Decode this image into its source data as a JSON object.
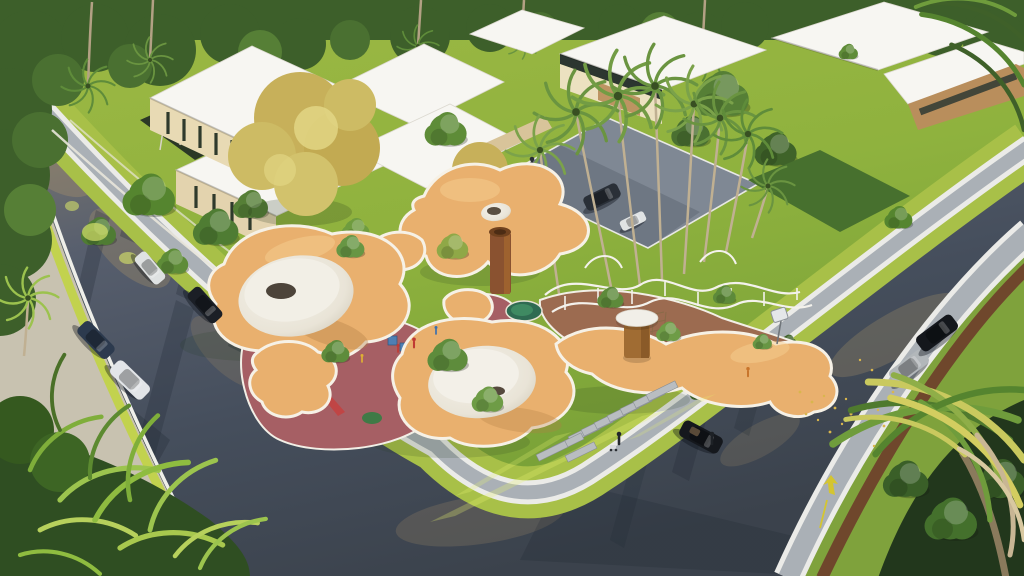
{
  "meta": {
    "kind": "3d-architectural-rendering",
    "view": "high aerial three-quarter perspective",
    "subject": "corner playground park with organic shade canopies, modern villas and palm-lined streets",
    "lighting": "late-afternoon sun from upper right casting long tree shadows"
  },
  "palette": {
    "grass_base": "#85a93c",
    "grass_strip": "#a8c048",
    "grass_bright": "#c2d24e",
    "asphalt": "#47505e",
    "asphalt_sunlit": "#8f8673",
    "asphalt_shadow": "#2c3340",
    "sidewalk": "#aab0b6",
    "curb_white": "#ebebe8",
    "verge_concrete": "#c8c2b0",
    "mulch": "#6e3d2a",
    "canopy": "#e9b06e",
    "canopy_highlight": "#f6cd8f",
    "canopy_shade": "#b37e45",
    "rim_white": "#f6f1e6",
    "sand": "#ece7db",
    "sand_shade": "#cdc6b6",
    "pit_dark": "#4d443a",
    "rubber_red": "#a65f64",
    "path_terracotta": "#9c6b50",
    "pool_green": "#2f6b52",
    "foliage_dark": "#3d5f2a",
    "foliage_mid": "#5e8c38",
    "foliage_light": "#8fb54a",
    "foliage_gold": "#c9b25c",
    "palm_green": "#6a9440",
    "palm_gold": "#d3cd60",
    "trunk": "#c0b092",
    "corten": "#8a5230",
    "roof_white": "#f7f6f2",
    "wall_cream": "#e8dab4",
    "wood": "#bd9462",
    "glazing": "#2f3a30",
    "car_white": "#e2e5e8",
    "car_black": "#16191f",
    "car_silver": "#b2b7ba",
    "car_navy": "#2c3a4e",
    "car_grey": "#2a3038",
    "marking_yellow": "#d4c531",
    "leaves_gold": "#d9b64d",
    "red_curb": "#b23a30"
  },
  "scene": {
    "streets": {
      "left_street": {
        "orientation": "runs from top-left corner down to bottom-center",
        "features": [
          "white curbs",
          "sunlit upper stretch",
          "tree shadow streaks",
          "red curb segment at top-left",
          "far-side concrete verge with ferns"
        ],
        "vehicles": [
          {
            "type": "sedan",
            "color": "white",
            "state": "driving"
          },
          {
            "type": "sedan",
            "color": "dark-blue",
            "state": "driving"
          },
          {
            "type": "sedan",
            "color": "black",
            "state": "driving"
          },
          {
            "type": "hatchback",
            "color": "white",
            "state": "driving"
          }
        ]
      },
      "right_street": {
        "orientation": "runs from top-right down to bottom-center corner",
        "features": [
          "yellow arrow curb marking",
          "scattered golden fallen leaves",
          "small white street sign",
          "wide far-side paver sidewalk with mulch planting strip"
        ],
        "vehicles": [
          {
            "type": "convertible",
            "color": "black",
            "state": "stopped with driver standing beside"
          },
          {
            "type": "hatchback",
            "color": "silver",
            "state": "parked at far curb"
          },
          {
            "type": "suv",
            "color": "black",
            "state": "parked at far curb"
          }
        ]
      }
    },
    "corner_lot": {
      "lawn": "bright green lawn with diagonal sunlight streaks",
      "sidewalk": "grey paver band with white curbs and grass strips wrapping the corner",
      "crosswalk": "staggered stepping-stone slabs leading from sidewalk to playground",
      "playground": {
        "canopy": "interconnected amoeba-shaped orange shade shells with white rims and cut-out holes",
        "features": [
          "white sand crater with dark pit",
          "sand island with trees growing through",
          "corten steel cylinder tower",
          "white-capped timber kiosk",
          "maroon rubber play areas",
          "terracotta loop path with white railings",
          "small green pool",
          "blue play cubes",
          "yellow sand ring",
          "swing frames",
          "climbing net",
          "children and adults playing"
        ]
      },
      "vegetation": {
        "palm_row": "row of tall palms along the right street edge",
        "golden_tree": "large golden-leaved tree over the left villas",
        "shrubs": "dense shrubs and hedge banks along the boundaries"
      }
    },
    "villas": {
      "style": "modern flat-roof white volumes with cream walls, timber accents and dark glazing slits",
      "clusters": 3,
      "garden": "terraced white garden walls with slender palm trunks",
      "plaza": {
        "surface": "blue-grey paver court",
        "vehicles": [
          {
            "type": "suv",
            "color": "dark-grey",
            "state": "parked"
          },
          {
            "type": "compact",
            "color": "white",
            "state": "parked"
          }
        ],
        "people": "one pedestrian"
      }
    },
    "foreground": {
      "bottom_left": "sunlit fern fronds and dark conifer overhanging the street",
      "bottom_right": "large palm crowns with golden-lit fronds and dry beige leaves",
      "top": "dense tree canopy with emergent palm trunks"
    }
  }
}
